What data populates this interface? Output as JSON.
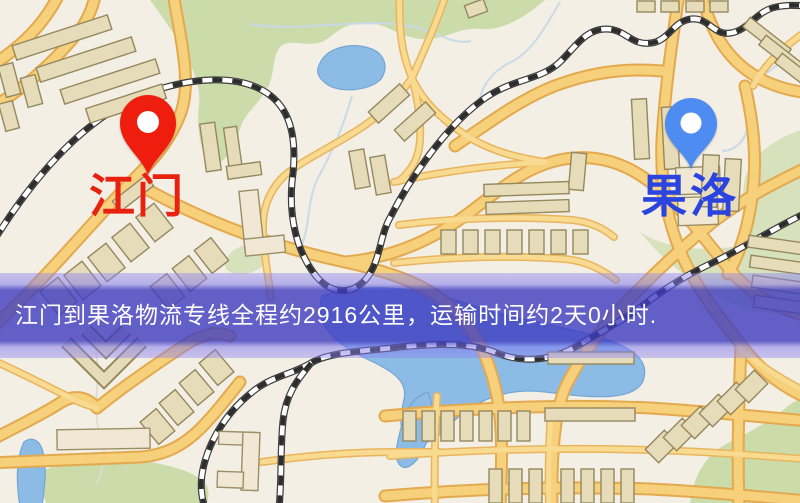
{
  "map": {
    "origin_marker": {
      "label": "江门",
      "label_color": "#e8220f",
      "pin_color": "#ee1d0e",
      "pin_icon": "red-map-pin"
    },
    "destination_marker": {
      "label": "果洛",
      "label_color": "#2a44dd",
      "pin_color": "#4f8cf2",
      "pin_icon": "blue-map-pin"
    },
    "banner": {
      "text": "江门到果洛物流专线全程约2916公里，运输时间约2天0小时.",
      "text_color": "#ffffff",
      "band_color": "#4a48c0"
    },
    "palette": {
      "land": "#f4efe5",
      "park": "#ccdbaa",
      "water": "#8cbbe6",
      "road": "#f6d07a",
      "road_casing": "#e3a94f",
      "railway": "#2d2d2d",
      "building": "#e7dcba"
    }
  }
}
